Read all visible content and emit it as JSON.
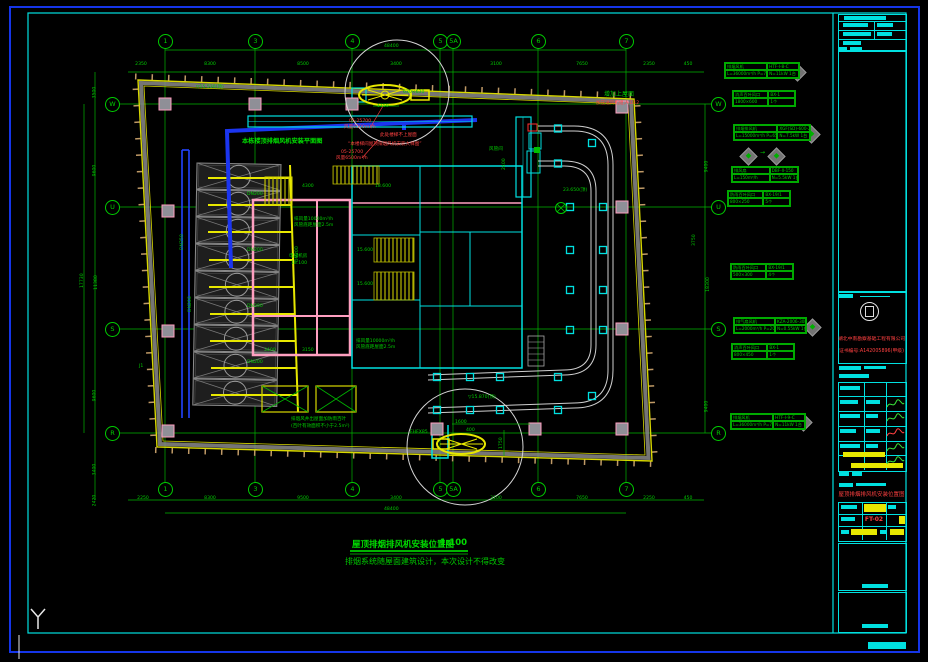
{
  "title": {
    "main": "屋顶排烟排风机安装位置图",
    "scale": "1:100",
    "note": "排烟系统随屋面建筑设计，本次设计不得改变"
  },
  "titleblock": {
    "company": "湖北中南勘察基础工程有限公司",
    "cert": "证书编号:A142005896(甲级)",
    "drawing_title": "屋顶排烟排风机安装位置图",
    "drawing_no": "FT-02"
  },
  "grid": {
    "cols": [
      {
        "t": "1",
        "x": 165
      },
      {
        "t": "3",
        "x": 255
      },
      {
        "t": "4",
        "x": 352
      },
      {
        "t": "5",
        "x": 440
      },
      {
        "t": "5A",
        "x": 453
      },
      {
        "t": "6",
        "x": 538
      },
      {
        "t": "7",
        "x": 626
      }
    ],
    "rows": [
      {
        "t": "W",
        "y": 104
      },
      {
        "t": "U",
        "y": 207
      },
      {
        "t": "S",
        "y": 329
      },
      {
        "t": "R",
        "y": 433
      }
    ]
  },
  "dims": {
    "top": [
      {
        "t": "2350",
        "x": 141
      },
      {
        "t": "8300",
        "x": 210
      },
      {
        "t": "8500",
        "x": 303
      },
      {
        "t": "3400",
        "x": 396
      },
      {
        "t": "3100",
        "x": 496
      },
      {
        "t": "7650",
        "x": 582
      },
      {
        "t": "2350",
        "x": 649
      },
      {
        "t": "450",
        "x": 688
      }
    ],
    "bottom": [
      {
        "t": "2250",
        "x": 143
      },
      {
        "t": "8300",
        "x": 210
      },
      {
        "t": "9500",
        "x": 303
      },
      {
        "t": "3400",
        "x": 396
      },
      {
        "t": "3100",
        "x": 496
      },
      {
        "t": "7650",
        "x": 582
      },
      {
        "t": "2250",
        "x": 649
      },
      {
        "t": "450",
        "x": 688
      }
    ],
    "left": [
      {
        "t": "3500",
        "y": 90
      },
      {
        "t": "9600",
        "y": 168
      },
      {
        "t": "11380",
        "y": 280
      },
      {
        "t": "9600",
        "y": 393
      },
      {
        "t": "3400",
        "y": 467
      },
      {
        "t": "2420",
        "y": 498
      }
    ],
    "right": [
      {
        "t": "9400",
        "y": 164
      },
      {
        "t": "18300",
        "y": 282
      },
      {
        "t": "9400",
        "y": 404
      }
    ]
  },
  "tags": [
    {
      "name": "排烟风机",
      "model": "HTF-I-8-C",
      "l2": "L=36000m³/h P=700Pa",
      "r2": "N=11kW 1台",
      "x": 724,
      "y": 62,
      "w": 74
    },
    {
      "name": "消声百叶风口",
      "model": "BX-1",
      "l2": "1800×600",
      "r2": "1个",
      "x": 732,
      "y": 90,
      "w": 62
    },
    {
      "name": "排烟排风机",
      "model": "XGF(SD)-600-2S",
      "l2": "L=15000m³/h P=650Pa",
      "r2": "N=7.5kW 1台",
      "x": 733,
      "y": 124,
      "w": 76
    },
    {
      "name": "排风扇",
      "model": "DBF-II-150",
      "l2": "L=150m³/h",
      "r2": "N=5.5kW 1台",
      "x": 731,
      "y": 166,
      "w": 66
    },
    {
      "name": "防雨百叶风口",
      "model": "BX-19/1",
      "l2": "800×250",
      "r2": "5个",
      "x": 727,
      "y": 190,
      "w": 62
    },
    {
      "name": "防雨百叶风口",
      "model": "BX-19/1",
      "l2": "500×300",
      "r2": "4个",
      "x": 730,
      "y": 263,
      "w": 62
    },
    {
      "name": "排气扇风机",
      "model": "KZA-2006-30B",
      "l2": "L=2000m³/h P=200Pa",
      "r2": "N=0.55kW 1台",
      "x": 733,
      "y": 317,
      "w": 72
    },
    {
      "name": "消声百叶风口",
      "model": "BX-1",
      "l2": "800×450",
      "r2": "1个",
      "x": 731,
      "y": 343,
      "w": 62
    },
    {
      "name": "排烟风机",
      "model": "HTF-I-9-C",
      "l2": "L=36000m³/h P=700Pa",
      "r2": "N=11kW 1台",
      "x": 730,
      "y": 413,
      "w": 74
    }
  ],
  "diamonds": [
    {
      "x": 791,
      "y": 66
    },
    {
      "x": 805,
      "y": 128
    },
    {
      "x": 742,
      "y": 150
    },
    {
      "x": 770,
      "y": 150
    },
    {
      "x": 806,
      "y": 321
    },
    {
      "x": 797,
      "y": 416
    }
  ],
  "labels": [
    {
      "t": "▽15.530(顶)",
      "x": 196,
      "y": 85,
      "cls": "g"
    },
    {
      "t": "本栋楼顶排烟风机安装平面图",
      "x": 242,
      "y": 138,
      "cls": "gb"
    },
    {
      "t": "增加上屋面",
      "x": 604,
      "y": 92,
      "cls": "s6"
    },
    {
      "t": "加压送风机组;A-D12",
      "x": 596,
      "y": 101,
      "cls": "r"
    },
    {
      "t": "05-25700",
      "x": 349,
      "y": 119,
      "cls": "r"
    },
    {
      "t": "风量6500m³/h",
      "x": 344,
      "y": 125,
      "cls": "r"
    },
    {
      "t": "05-25700",
      "x": 341,
      "y": 150,
      "cls": "r"
    },
    {
      "t": "风量6500m³/h",
      "x": 336,
      "y": 156,
      "cls": "r"
    },
    {
      "t": "此处楼梯不上屋面",
      "x": 380,
      "y": 133,
      "cls": "r"
    },
    {
      "t": "“本楼梯间屋顶排烟风机安装大样图”",
      "x": 348,
      "y": 142,
      "cls": "r"
    },
    {
      "t": "630×630",
      "x": 403,
      "y": 90,
      "cls": ""
    },
    {
      "t": "1150",
      "x": 377,
      "y": 104,
      "cls": ""
    },
    {
      "t": "风管间",
      "x": 489,
      "y": 147,
      "cls": ""
    },
    {
      "t": "2400",
      "x": 502,
      "y": 170,
      "cls": "rot"
    },
    {
      "t": "DN200",
      "x": 247,
      "y": 192,
      "cls": ""
    },
    {
      "t": "DN200",
      "x": 247,
      "y": 248,
      "cls": ""
    },
    {
      "t": "DN200",
      "x": 247,
      "y": 304,
      "cls": ""
    },
    {
      "t": "DN200",
      "x": 247,
      "y": 360,
      "cls": ""
    },
    {
      "t": "DN200",
      "x": 295,
      "y": 262,
      "cls": "rot"
    },
    {
      "t": "DN250",
      "x": 180,
      "y": 250,
      "cls": "rot"
    },
    {
      "t": "DN200",
      "x": 188,
      "y": 312,
      "cls": "rot"
    },
    {
      "t": "18.600",
      "x": 375,
      "y": 184,
      "cls": ""
    },
    {
      "t": "15.600",
      "x": 357,
      "y": 248,
      "cls": ""
    },
    {
      "t": "15.600",
      "x": 357,
      "y": 282,
      "cls": ""
    },
    {
      "t": "排风量10000m³/h",
      "x": 294,
      "y": 217,
      "cls": ""
    },
    {
      "t": "风管底距屋面2.5m",
      "x": 294,
      "y": 223,
      "cls": ""
    },
    {
      "t": "排风量10000m³/h",
      "x": 356,
      "y": 339,
      "cls": ""
    },
    {
      "t": "风管底距屋面2.5m",
      "x": 356,
      "y": 345,
      "cls": ""
    },
    {
      "t": "23.650(顶)",
      "x": 563,
      "y": 188,
      "cls": ""
    },
    {
      "t": "▽15.870(顶)",
      "x": 468,
      "y": 395,
      "cls": ""
    },
    {
      "t": "1600",
      "x": 455,
      "y": 420,
      "cls": ""
    },
    {
      "t": "400",
      "x": 466,
      "y": 428,
      "cls": ""
    },
    {
      "t": "1750",
      "x": 499,
      "y": 449,
      "cls": "rot"
    },
    {
      "t": "FHFX85",
      "x": 410,
      "y": 430,
      "cls": ""
    },
    {
      "t": "电梯机房",
      "x": 289,
      "y": 254,
      "cls": ""
    },
    {
      "t": "18.100",
      "x": 291,
      "y": 261,
      "cls": ""
    },
    {
      "t": "排烟风井出屋面加防雨百叶",
      "x": 291,
      "y": 417,
      "cls": ""
    },
    {
      "t": "(百叶有效面积不小于2.5m²)",
      "x": 291,
      "y": 424,
      "cls": ""
    },
    {
      "t": "J1",
      "x": 139,
      "y": 364,
      "cls": ""
    },
    {
      "t": "4300",
      "x": 302,
      "y": 184,
      "cls": ""
    },
    {
      "t": "3400",
      "x": 264,
      "y": 348,
      "cls": ""
    },
    {
      "t": "3150",
      "x": 302,
      "y": 348,
      "cls": ""
    },
    {
      "t": "→",
      "x": 760,
      "y": 150,
      "cls": "s6"
    },
    {
      "t": "48400",
      "x": 384,
      "y": 44,
      "cls": ""
    },
    {
      "t": "48400",
      "x": 384,
      "y": 507,
      "cls": ""
    },
    {
      "t": "17730",
      "x": 80,
      "y": 288,
      "cls": "rot"
    },
    {
      "t": "3750",
      "x": 692,
      "y": 246,
      "cls": "rot"
    }
  ]
}
